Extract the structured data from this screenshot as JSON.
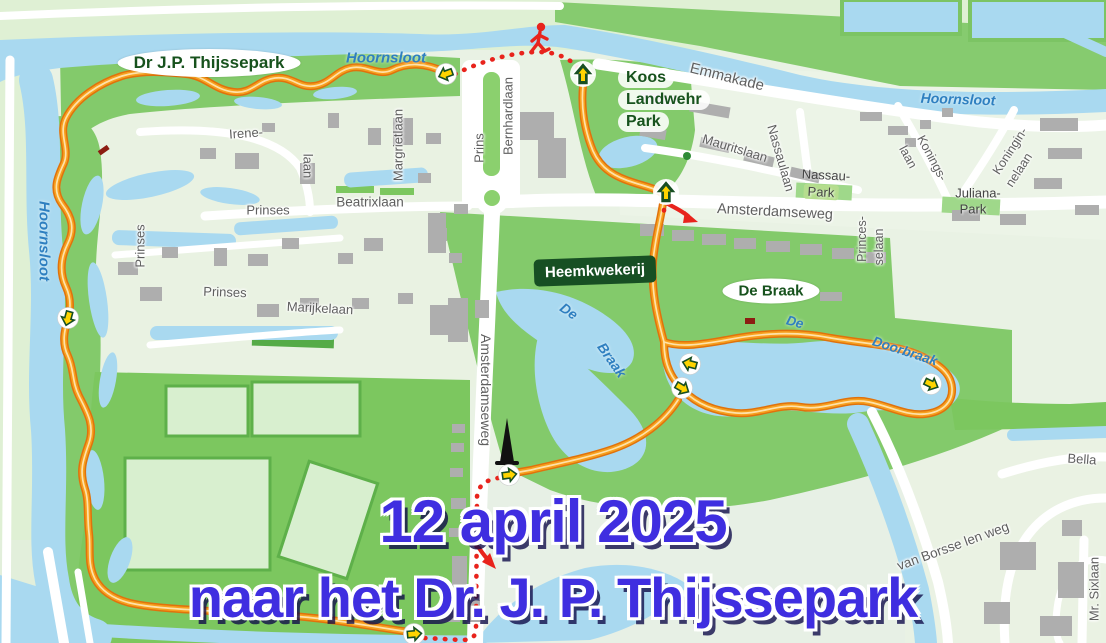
{
  "event": {
    "date_line": "12 april 2025",
    "destination_line": "naar het Dr. J. P. Thijssepark",
    "text_color": "#3f2ee0"
  },
  "map": {
    "parks": {
      "thijssepark": "Dr J.P. Thijssepark",
      "koos_line1": "Koos",
      "koos_line2": "Landwehr",
      "koos_line3": "Park",
      "de_braak": "De Braak",
      "heemkwekerij": "Heemkwekerij",
      "nassau_park_line1": "Nassau-",
      "nassau_park_line2": "Park",
      "juliana_park_line1": "Juliana-",
      "juliana_park_line2": "Park"
    },
    "waterways": {
      "hoornsloot_top": "Hoornsloot",
      "hoornsloot_left": "Hoornsloot",
      "hoornsloot_right": "Hoornsloot",
      "de_braak_de": "De",
      "de_braak_braak": "Braak",
      "doorbraak_de": "De",
      "doorbraak_name": "Doorbraak"
    },
    "streets": {
      "emmakade": "Emmakade",
      "irene_part1": "Irene-",
      "irene_part2": "laan",
      "margrietlaan": "Margrietlaan",
      "prins": "Prins",
      "bernhardlaan": "Bernhardlaan",
      "prinses_west": "Prinses",
      "prinses_north": "Prinses",
      "prinses_mid": "Prinses",
      "beatrixlaan": "Beatrixlaan",
      "marijkelaan": "Marijkelaan",
      "mauritslaan": "Mauritslaan",
      "nassaulaan": "Nassaulaan",
      "konings_part1": "Konings-",
      "konings_part2": "laan",
      "koningin_part1": "Koningin-",
      "koningin_part2": "nelaan",
      "amsterdamseweg_horizontal": "Amsterdamseweg",
      "amsterdamseweg_vertical": "Amsterdamseweg",
      "princesselaan_part1": "Princes-",
      "princesselaan_part2": "selaan",
      "van_borsselenweg": "van Borsse len weg",
      "mr_sixlaan": "Mr. Sixlaan",
      "bella": "Bella"
    },
    "route": {
      "line_color": "#e0720c",
      "fill_color": "#f7a01e",
      "dotted_color": "#e8231c",
      "marker_arrow_color": "#ffd400",
      "marker_green": "#174f23"
    }
  }
}
